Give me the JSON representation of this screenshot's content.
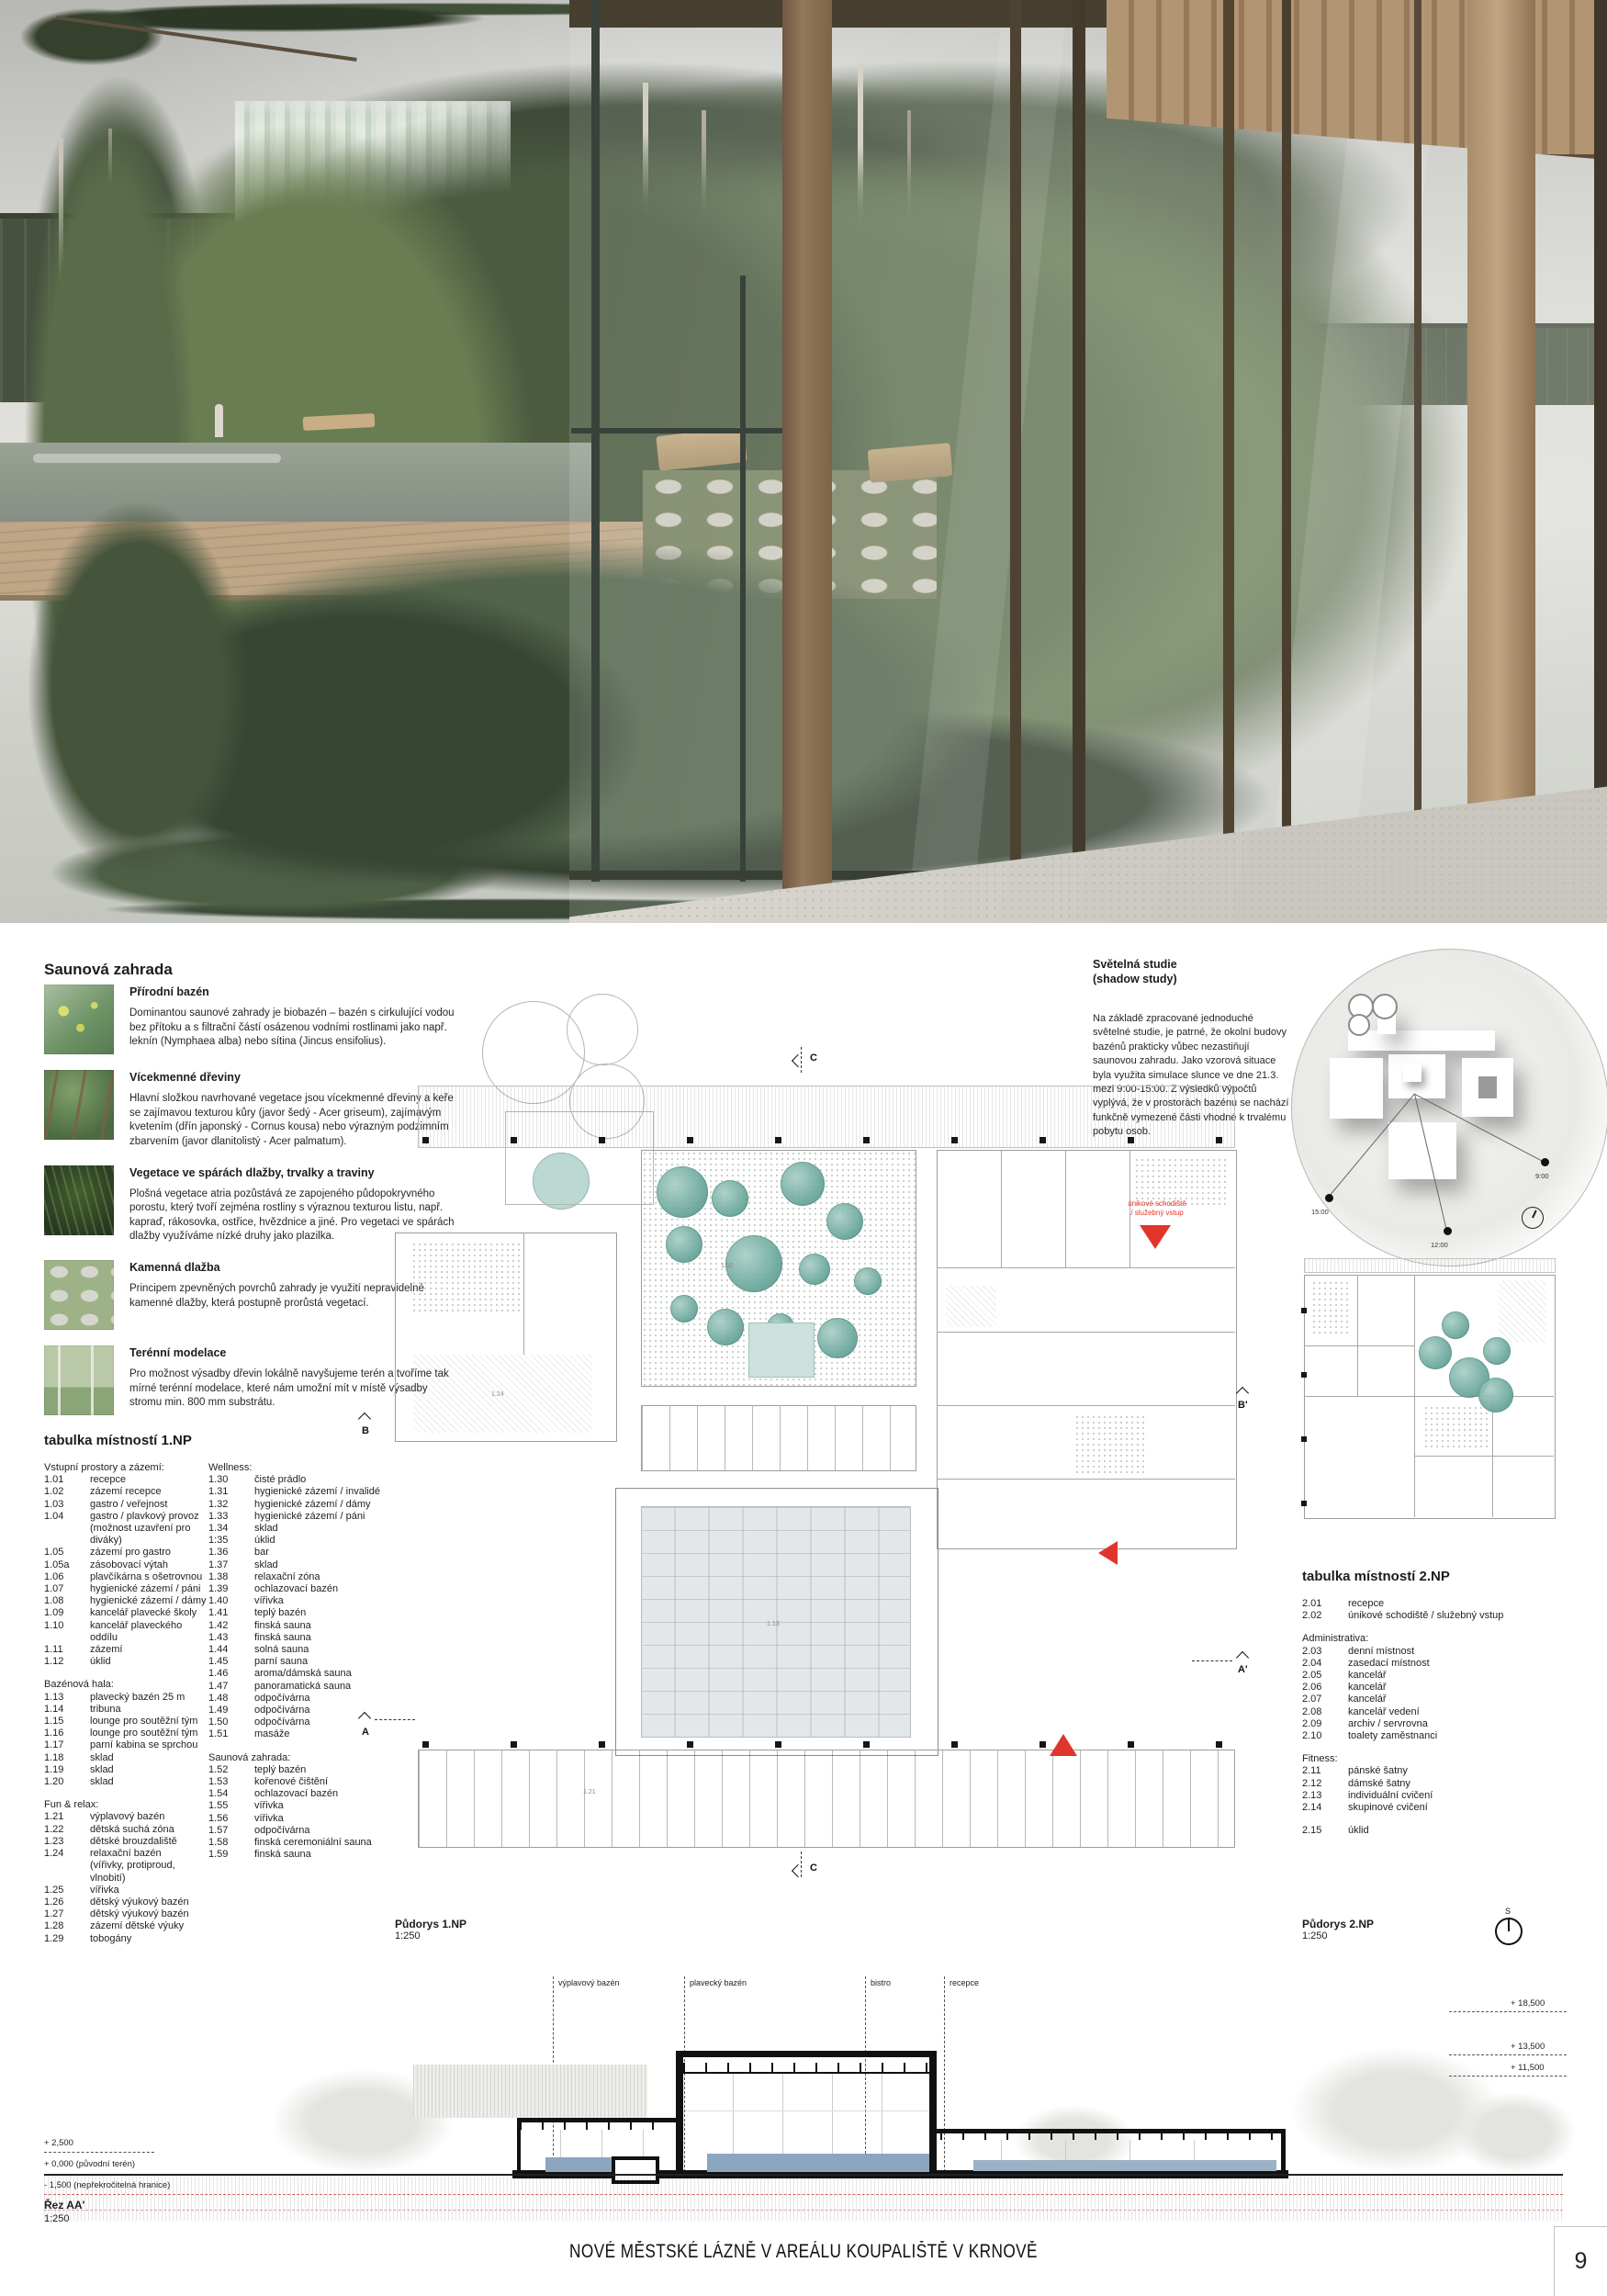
{
  "footer": {
    "title": "NOVÉ MĚSTSKÉ LÁZNĚ V AREÁLU KOUPALIŠTĚ V KRNOVĚ",
    "page": "9"
  },
  "sauna_garden": {
    "title": "Saunová zahrada",
    "items": [
      {
        "thumb": "th1",
        "heading": "Přírodní bazén",
        "text": "Dominantou saunové zahrady je biobazén – bazén s cirkulující vodou bez přítoku a s filtrační částí osázenou vodními rostlinami jako např. leknín (Nymphaea alba) nebo sítina (Jincus ensifolius)."
      },
      {
        "thumb": "th2",
        "heading": "Vícekmenné dřeviny",
        "text": "Hlavní složkou navrhované vegetace jsou vícekmenné dřeviny a keře se zajímavou texturou kůry (javor šedý - Acer griseum), zajímavým kvetením (dřín japonský - Cornus kousa) nebo výrazným podzimním zbarvením (javor dlanitolistý - Acer palmatum)."
      },
      {
        "thumb": "th3",
        "heading": "Vegetace ve spárách dlažby, trvalky a traviny",
        "text": "Plošná vegetace atria pozůstává ze zapojeného půdopokryvného porostu, který tvoří zejména rostliny s výraznou texturou listu, např. kapraď, rákosovka, ostřice, hvězdnice a jiné. Pro vegetaci ve spárách dlažby využíváme nízké druhy jako plazilka."
      },
      {
        "thumb": "th4",
        "heading": "Kamenná dlažba",
        "text": "Principem zpevněných povrchů zahrady je využití nepravidelné kamenné dlažby, která postupně prorůstá vegetací."
      },
      {
        "thumb": "th5",
        "heading": "Terénní modelace",
        "text": "Pro možnost výsadby dřevin lokálně navyšujeme terén a tvoříme tak mírné terénní modelace, které nám umožní mít v místě výsadby stromu min. 800 mm substrátu."
      }
    ]
  },
  "shadow_study": {
    "title_line1": "Světelná studie",
    "title_line2": "(shadow study)",
    "text": "Na základě zpracované jednoduché světelné studie, je patrné, že okolní budovy bazénů prakticky vůbec nezastiňují saunovou zahradu. Jako vzorová situace byla využita simulace slunce ve dne 21.3. mezi 9:00-15:00. Z výsledků výpočtů vyplývá, že v prostorách bazénu se nachází funkčně vymezené části vhodné k trvalému pobytu osob.",
    "times": [
      "9:00",
      "12:00",
      "15:00"
    ]
  },
  "table_1np": {
    "title": "tabulka místností 1.NP",
    "col1": [
      {
        "cls": "th",
        "n": "Vstupní prostory a zázemí:"
      },
      {
        "n": "1.01",
        "label": "recepce"
      },
      {
        "n": "1.02",
        "label": "zázemí recepce"
      },
      {
        "n": "1.03",
        "label": "gastro / veřejnost"
      },
      {
        "n": "1.04",
        "label": "gastro / plavkový provoz"
      },
      {
        "n": "",
        "label": "(možnost uzavření pro diváky)"
      },
      {
        "n": "1.05",
        "label": "zázemí pro gastro"
      },
      {
        "n": "1.05a",
        "label": "zásobovací výtah"
      },
      {
        "n": "1.06",
        "label": "plavčíkárna s ošetrovnou"
      },
      {
        "n": "1.07",
        "label": "hygienické zázemí / páni"
      },
      {
        "n": "1.08",
        "label": "hygienické zázemí / dámy"
      },
      {
        "n": "1.09",
        "label": "kancelář plavecké školy"
      },
      {
        "n": "1.10",
        "label": "kancelář plaveckého oddílu"
      },
      {
        "n": "1.11",
        "label": "zázemí"
      },
      {
        "n": "1.12",
        "label": "úklid"
      },
      {
        "cls": "gap"
      },
      {
        "cls": "th",
        "n": "Bazénová hala:"
      },
      {
        "n": "1.13",
        "label": "plavecký bazén 25 m"
      },
      {
        "n": "1.14",
        "label": "tribuna"
      },
      {
        "n": "1.15",
        "label": "lounge pro soutěžní tým"
      },
      {
        "n": "1.16",
        "label": "lounge pro soutěžní tým"
      },
      {
        "n": "1.17",
        "label": "parní kabina se sprchou"
      },
      {
        "n": "1.18",
        "label": "sklad"
      },
      {
        "n": "1.19",
        "label": "sklad"
      },
      {
        "n": "1.20",
        "label": "sklad"
      },
      {
        "cls": "gap"
      },
      {
        "cls": "th",
        "n": "Fun & relax:"
      },
      {
        "n": "1.21",
        "label": "výplavový bazén"
      },
      {
        "n": "1.22",
        "label": "dětská suchá zóna"
      },
      {
        "n": "1.23",
        "label": "dětské brouzdaliště"
      },
      {
        "n": "1.24",
        "label": "relaxační bazén"
      },
      {
        "n": "",
        "label": "(vířivky, protiproud, vlnobití)"
      },
      {
        "n": "1.25",
        "label": "vířivka"
      },
      {
        "n": "1.26",
        "label": "dětský výukový bazén"
      },
      {
        "n": "1.27",
        "label": "dětský výukový bazén"
      },
      {
        "n": "1.28",
        "label": "zázemí dětské výuky"
      },
      {
        "n": "1.29",
        "label": "tobogány"
      }
    ],
    "col2": [
      {
        "cls": "th",
        "n": "Wellness:"
      },
      {
        "n": "1.30",
        "label": "čisté prádlo"
      },
      {
        "n": "1.31",
        "label": "hygienické zázemí / invalidé"
      },
      {
        "n": "1.32",
        "label": "hygienické zázemí / dámy"
      },
      {
        "n": "1.33",
        "label": "hygienické zázemí / páni"
      },
      {
        "n": "1.34",
        "label": "sklad"
      },
      {
        "n": "1:35",
        "label": "úklid"
      },
      {
        "n": "1.36",
        "label": "bar"
      },
      {
        "n": "1.37",
        "label": "sklad"
      },
      {
        "n": "1.38",
        "label": "relaxační zóna"
      },
      {
        "n": "1.39",
        "label": "ochlazovací bazén"
      },
      {
        "n": "1.40",
        "label": "vířivka"
      },
      {
        "n": "1.41",
        "label": "teplý bazén"
      },
      {
        "n": "1.42",
        "label": "finská sauna"
      },
      {
        "n": "1.43",
        "label": "finská sauna"
      },
      {
        "n": "1.44",
        "label": "solná sauna"
      },
      {
        "n": "1.45",
        "label": "parní sauna"
      },
      {
        "n": "1.46",
        "label": "aroma/dámská sauna"
      },
      {
        "n": "1.47",
        "label": "panoramatická sauna"
      },
      {
        "n": "1.48",
        "label": "odpočívárna"
      },
      {
        "n": "1.49",
        "label": "odpočívárna"
      },
      {
        "n": "1.50",
        "label": "odpočívárna"
      },
      {
        "n": "1.51",
        "label": "masáže"
      },
      {
        "cls": "gap"
      },
      {
        "cls": "th",
        "n": "Saunová zahrada:"
      },
      {
        "n": "1.52",
        "label": "teplý bazén"
      },
      {
        "n": "1.53",
        "label": "kořenové čištění"
      },
      {
        "n": "1.54",
        "label": "ochlazovací bazén"
      },
      {
        "n": "1.55",
        "label": "vířivka"
      },
      {
        "n": "1.56",
        "label": "vířivka"
      },
      {
        "n": "1.57",
        "label": "odpočívárna"
      },
      {
        "n": "1.58",
        "label": "finská ceremoniální sauna"
      },
      {
        "n": "1.59",
        "label": "finská sauna"
      }
    ]
  },
  "table_2np": {
    "title": "tabulka místností 2.NP",
    "rows": [
      {
        "n": "2.01",
        "label": "recepce"
      },
      {
        "n": "2.02",
        "label": "únikové schodiště / služebný vstup"
      },
      {
        "cls": "gap"
      },
      {
        "cls": "th",
        "n": "Administrativa:"
      },
      {
        "n": "2.03",
        "label": "denní místnost"
      },
      {
        "n": "2.04",
        "label": "zasedací místnost"
      },
      {
        "n": "2.05",
        "label": "kancelář"
      },
      {
        "n": "2.06",
        "label": "kancelář"
      },
      {
        "n": "2.07",
        "label": "kancelář"
      },
      {
        "n": "2.08",
        "label": "kancelář vedení"
      },
      {
        "n": "2.09",
        "label": "archiv / servrovna"
      },
      {
        "n": "2.10",
        "label": "toalety zaměstnanci"
      },
      {
        "cls": "gap"
      },
      {
        "cls": "th",
        "n": "Fitness:"
      },
      {
        "n": "2.11",
        "label": "pánské šatny"
      },
      {
        "n": "2.12",
        "label": "dámské šatny"
      },
      {
        "n": "2.13",
        "label": "individuální cvičení"
      },
      {
        "n": "2.14",
        "label": "skupinové cvičení"
      },
      {
        "cls": "gap"
      },
      {
        "n": "2.15",
        "label": "úklid"
      }
    ]
  },
  "plans": {
    "plan1": {
      "label": "Půdorys 1.NP",
      "scale": "1:250"
    },
    "plan2": {
      "label": "Půdorys 2.NP",
      "scale": "1:250"
    },
    "annotation": {
      "line1": "únikové schodiště",
      "line2": "/ služebný vstup"
    },
    "markers": {
      "a": "A",
      "a_prime": "A'",
      "b": "B",
      "b_prime": "B'",
      "c": "C",
      "north": "S"
    },
    "room_numbers": [
      "1.52",
      "1.13",
      "1.24",
      "1.21"
    ],
    "accent_red": "#e0352b",
    "vegetation_teal": "#6aa79c"
  },
  "section": {
    "name": "Řez AA'",
    "scale": "1:250",
    "labels": [
      "výplavový bazén",
      "plavecký bazén",
      "bistro",
      "recepce"
    ],
    "elev_right": [
      "+ 18,500",
      "+ 13,500",
      "+ 11,500"
    ],
    "elev_left": [
      "+ 2,500",
      "+ 0,000 (původní terén)",
      "- 1,500 (nepřekročitelná hranice)"
    ],
    "water_color": "#8ca6c0"
  }
}
